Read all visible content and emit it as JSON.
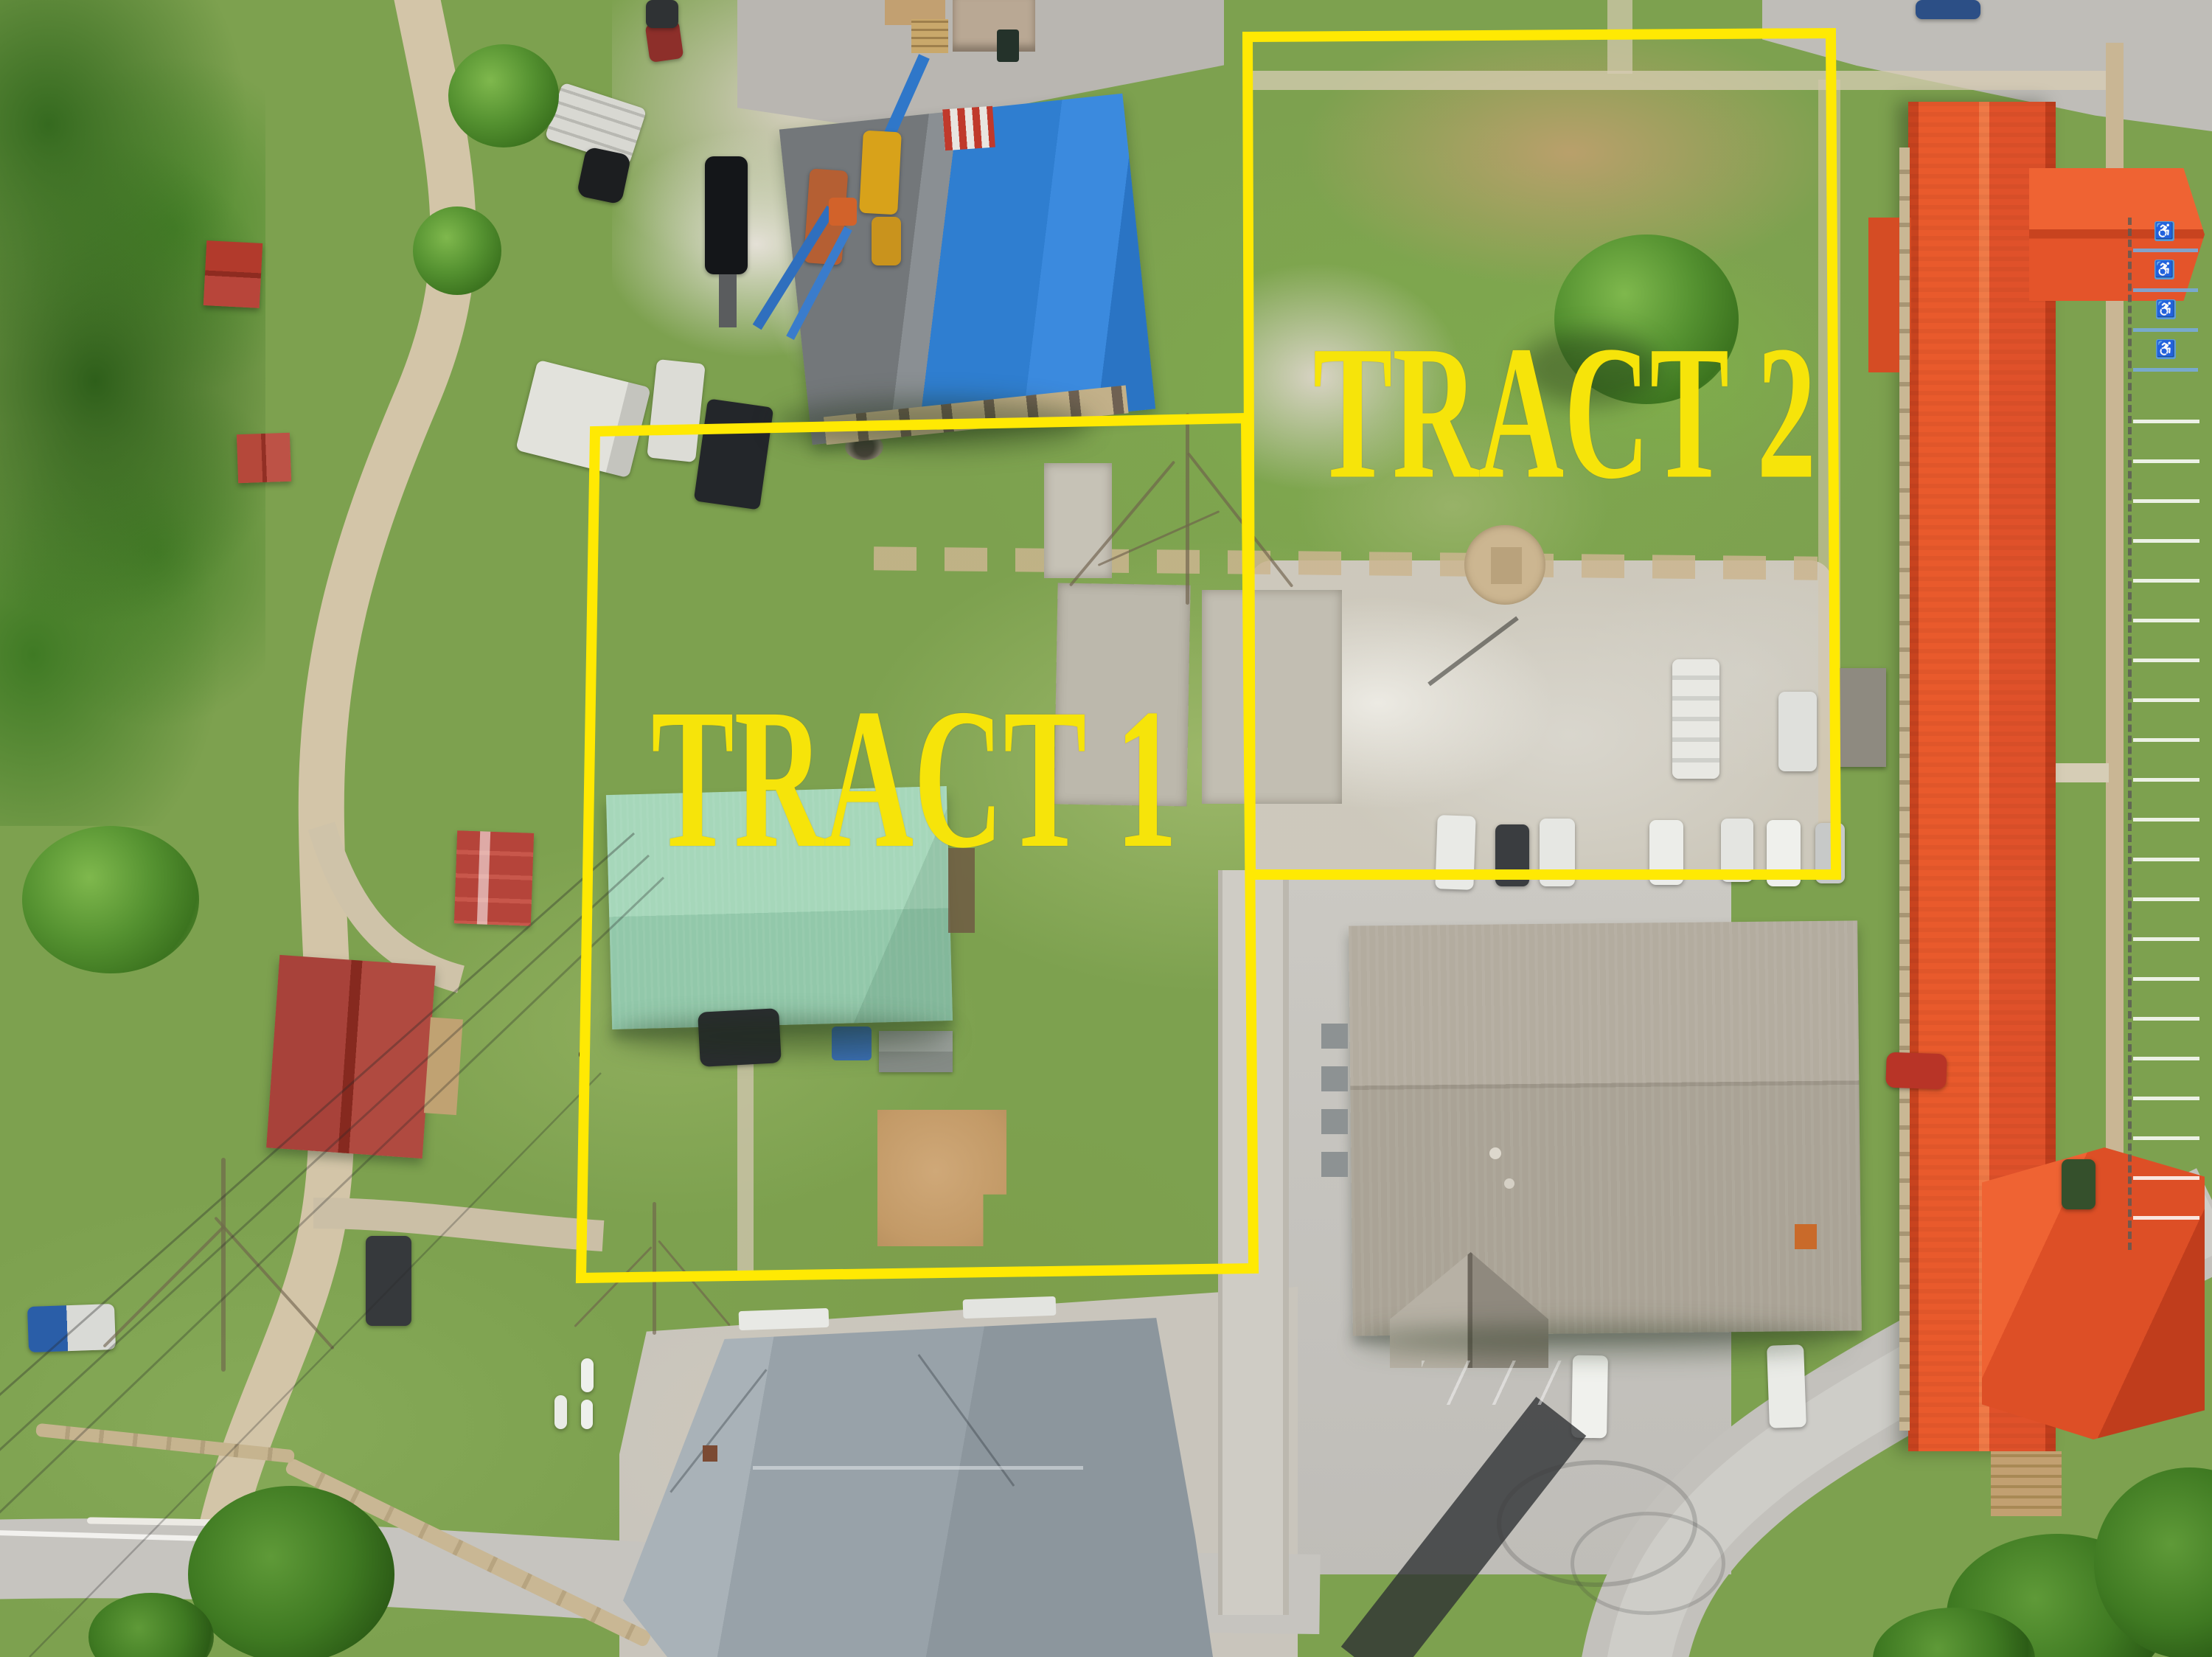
{
  "annotations": {
    "tract1_label": "TRACT 1",
    "tract2_label": "TRACT 2"
  },
  "icons": {
    "handicap": "♿"
  },
  "colors": {
    "boundary_yellow": "#ffe903",
    "label_yellow": "#f6e40a",
    "grass_base": "#7da14f",
    "tract1_roof_green": "#a6d7ba",
    "blue_roof": "#2f7ed0",
    "orange_roof": "#e95a2c",
    "red_roof": "#b0413a",
    "gray_shingle": "#9aa4ab",
    "church_tan": "#aaa396",
    "asphalt": "#c9c7c2",
    "gravel": "#d3c5a8"
  }
}
